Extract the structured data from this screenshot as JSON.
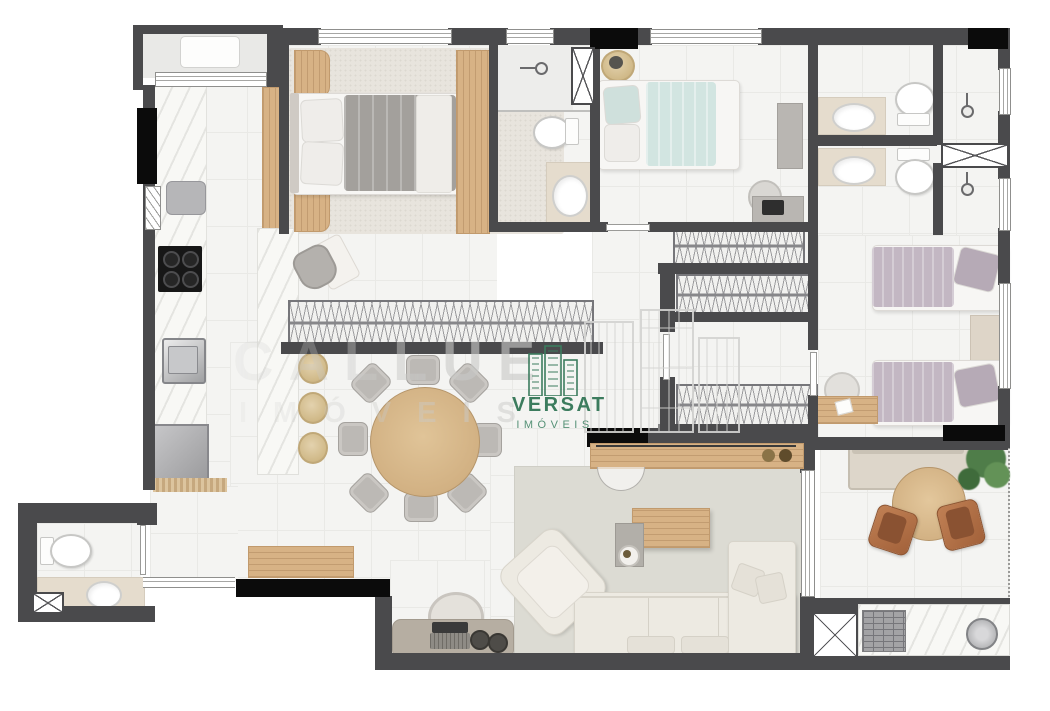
{
  "watermarks": {
    "callue": {
      "name": "CALLUE",
      "sub": "IMÓVEIS"
    },
    "versat": {
      "name": "VERSAT",
      "sub": "IMÓVEIS"
    }
  },
  "colors": {
    "wall": "#4a4a4c",
    "shaft": "#0b0b0b",
    "floor": "#f4f4f2",
    "grid": "#e9e9e6",
    "marble": "#f8f8f5",
    "stone": "#e5dccd",
    "wood": "#d7b285",
    "rug_master": "#e8e4dd",
    "rug_living": "#dcdbd3",
    "sofa": "#edeae2",
    "bed_gray": "#a3a09c",
    "bed_teal": "#d2e5e1",
    "bed_lavender": "#c3b7c3",
    "leather": "#a2613a",
    "plant": "#4f7d49",
    "versat_green": "#3c7c5e",
    "callue_gray": "#c9c9c7"
  }
}
